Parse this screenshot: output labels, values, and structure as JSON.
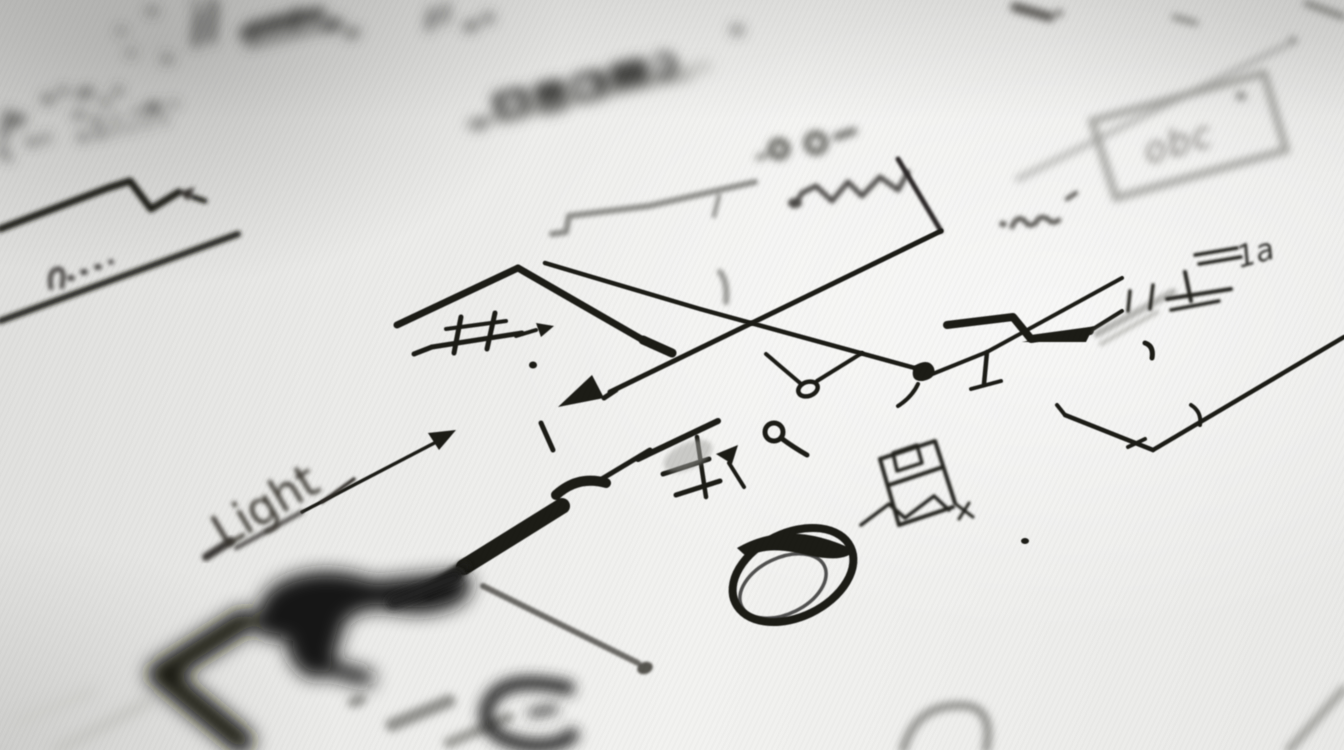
{
  "labels": {
    "light": "Light",
    "box": "obc",
    "connector": "1a"
  },
  "colors": {
    "paper": "#efeeec",
    "ink": "#1b1b19",
    "ink_soft": "#454543",
    "ink_gray": "#8c8c88",
    "ink_faint": "#b5b5b1"
  }
}
